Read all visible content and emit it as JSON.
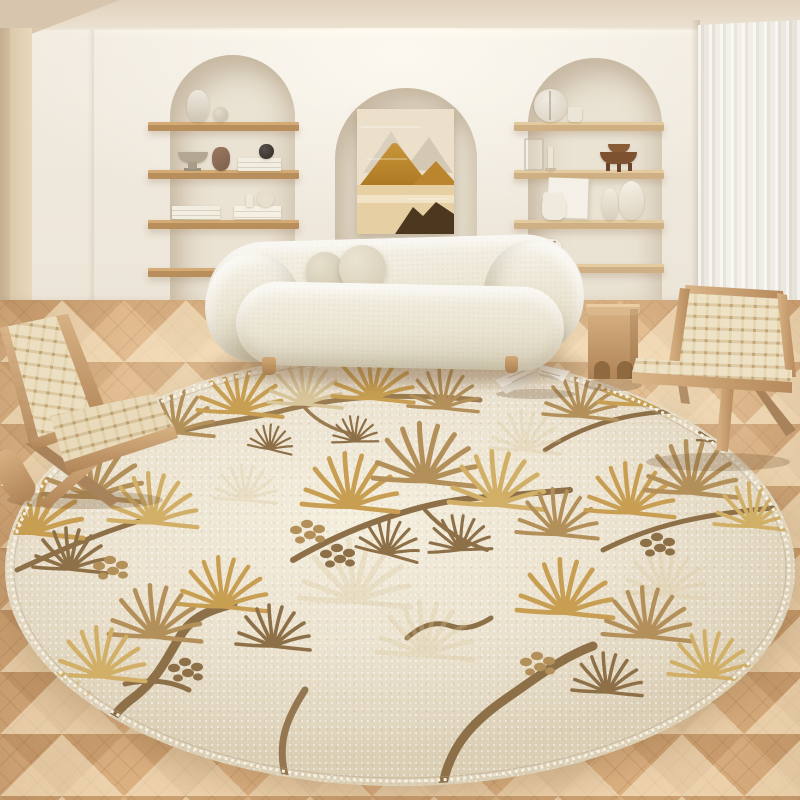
{
  "scene": {
    "label": "cream living room product photo",
    "description": "Round pine-motif rug in a beige living room with arched alcove shelving, curved boucle sofa, woven lounge chairs, wooden stool and chevron oak floor",
    "text_visible": "none"
  },
  "objects": {
    "artwork": "abstract mountain painting in center arch",
    "left_alcove": "arched niche with four wooden shelves",
    "center_alcove": "arched niche with artwork",
    "right_alcove": "arched niche with four wooden shelves",
    "curtain": "sheer curtain panel on right wall",
    "sofa": "curved cream boucle sofa",
    "pillow_small": "small round ball cushion",
    "pillow_large": "large round ball cushion",
    "rug": "round cream rug with golden pine branch motifs and stitched edge",
    "left_chair": "woven-strap wood lounge chair (left, partially visible)",
    "right_chair": "woven-strap wood lounge chair (right)",
    "stool": "carved wooden side stool with arch cutouts",
    "magazine": "open magazine lying on rug",
    "floor": "light oak chevron parquet floor",
    "shelf_items_left": [
      "white urn vase",
      "sphere vase",
      "footed bowl",
      "clay jug",
      "stacked books",
      "black vase",
      "stacked books",
      "white box",
      "small candle",
      "ring vase"
    ],
    "shelf_items_right": [
      "split disc sculpture",
      "small cup",
      "glass vase",
      "taper candle",
      "stacked wooden bowls",
      "leaning panel",
      "triple candle holder",
      "narrow vase",
      "oval vase",
      "spotted pot"
    ]
  },
  "colors": {
    "wall": "#f1ebe0",
    "ceiling": "#e0d2bd",
    "wallLeft": "#e8d8bc",
    "wallLeftDark": "#c4ae90",
    "alcove": "#eae2d3",
    "shelfLeft": "#b78e5c",
    "shelfLeftTop": "#d4ab74",
    "shelfRight": "#cfb084",
    "shelfRightTop": "#e3cb9f",
    "curtain": "#f4f1eb",
    "floor": "#dcb182",
    "sofaShade": "#d7cfb8",
    "pillow": "#cfc6ae",
    "rug": "#ebe2cf",
    "rugLight": "#f4eedd",
    "rugEdge": "#f7f1e3",
    "gold": "#c89f52",
    "gold2": "#d1af66",
    "tan": "#b3905a",
    "lightTan": "#d8c59a",
    "brown": "#8d7048",
    "wood": "#c79e6d",
    "woodDark": "#a8825a",
    "webbing": "#ecdfc1"
  }
}
